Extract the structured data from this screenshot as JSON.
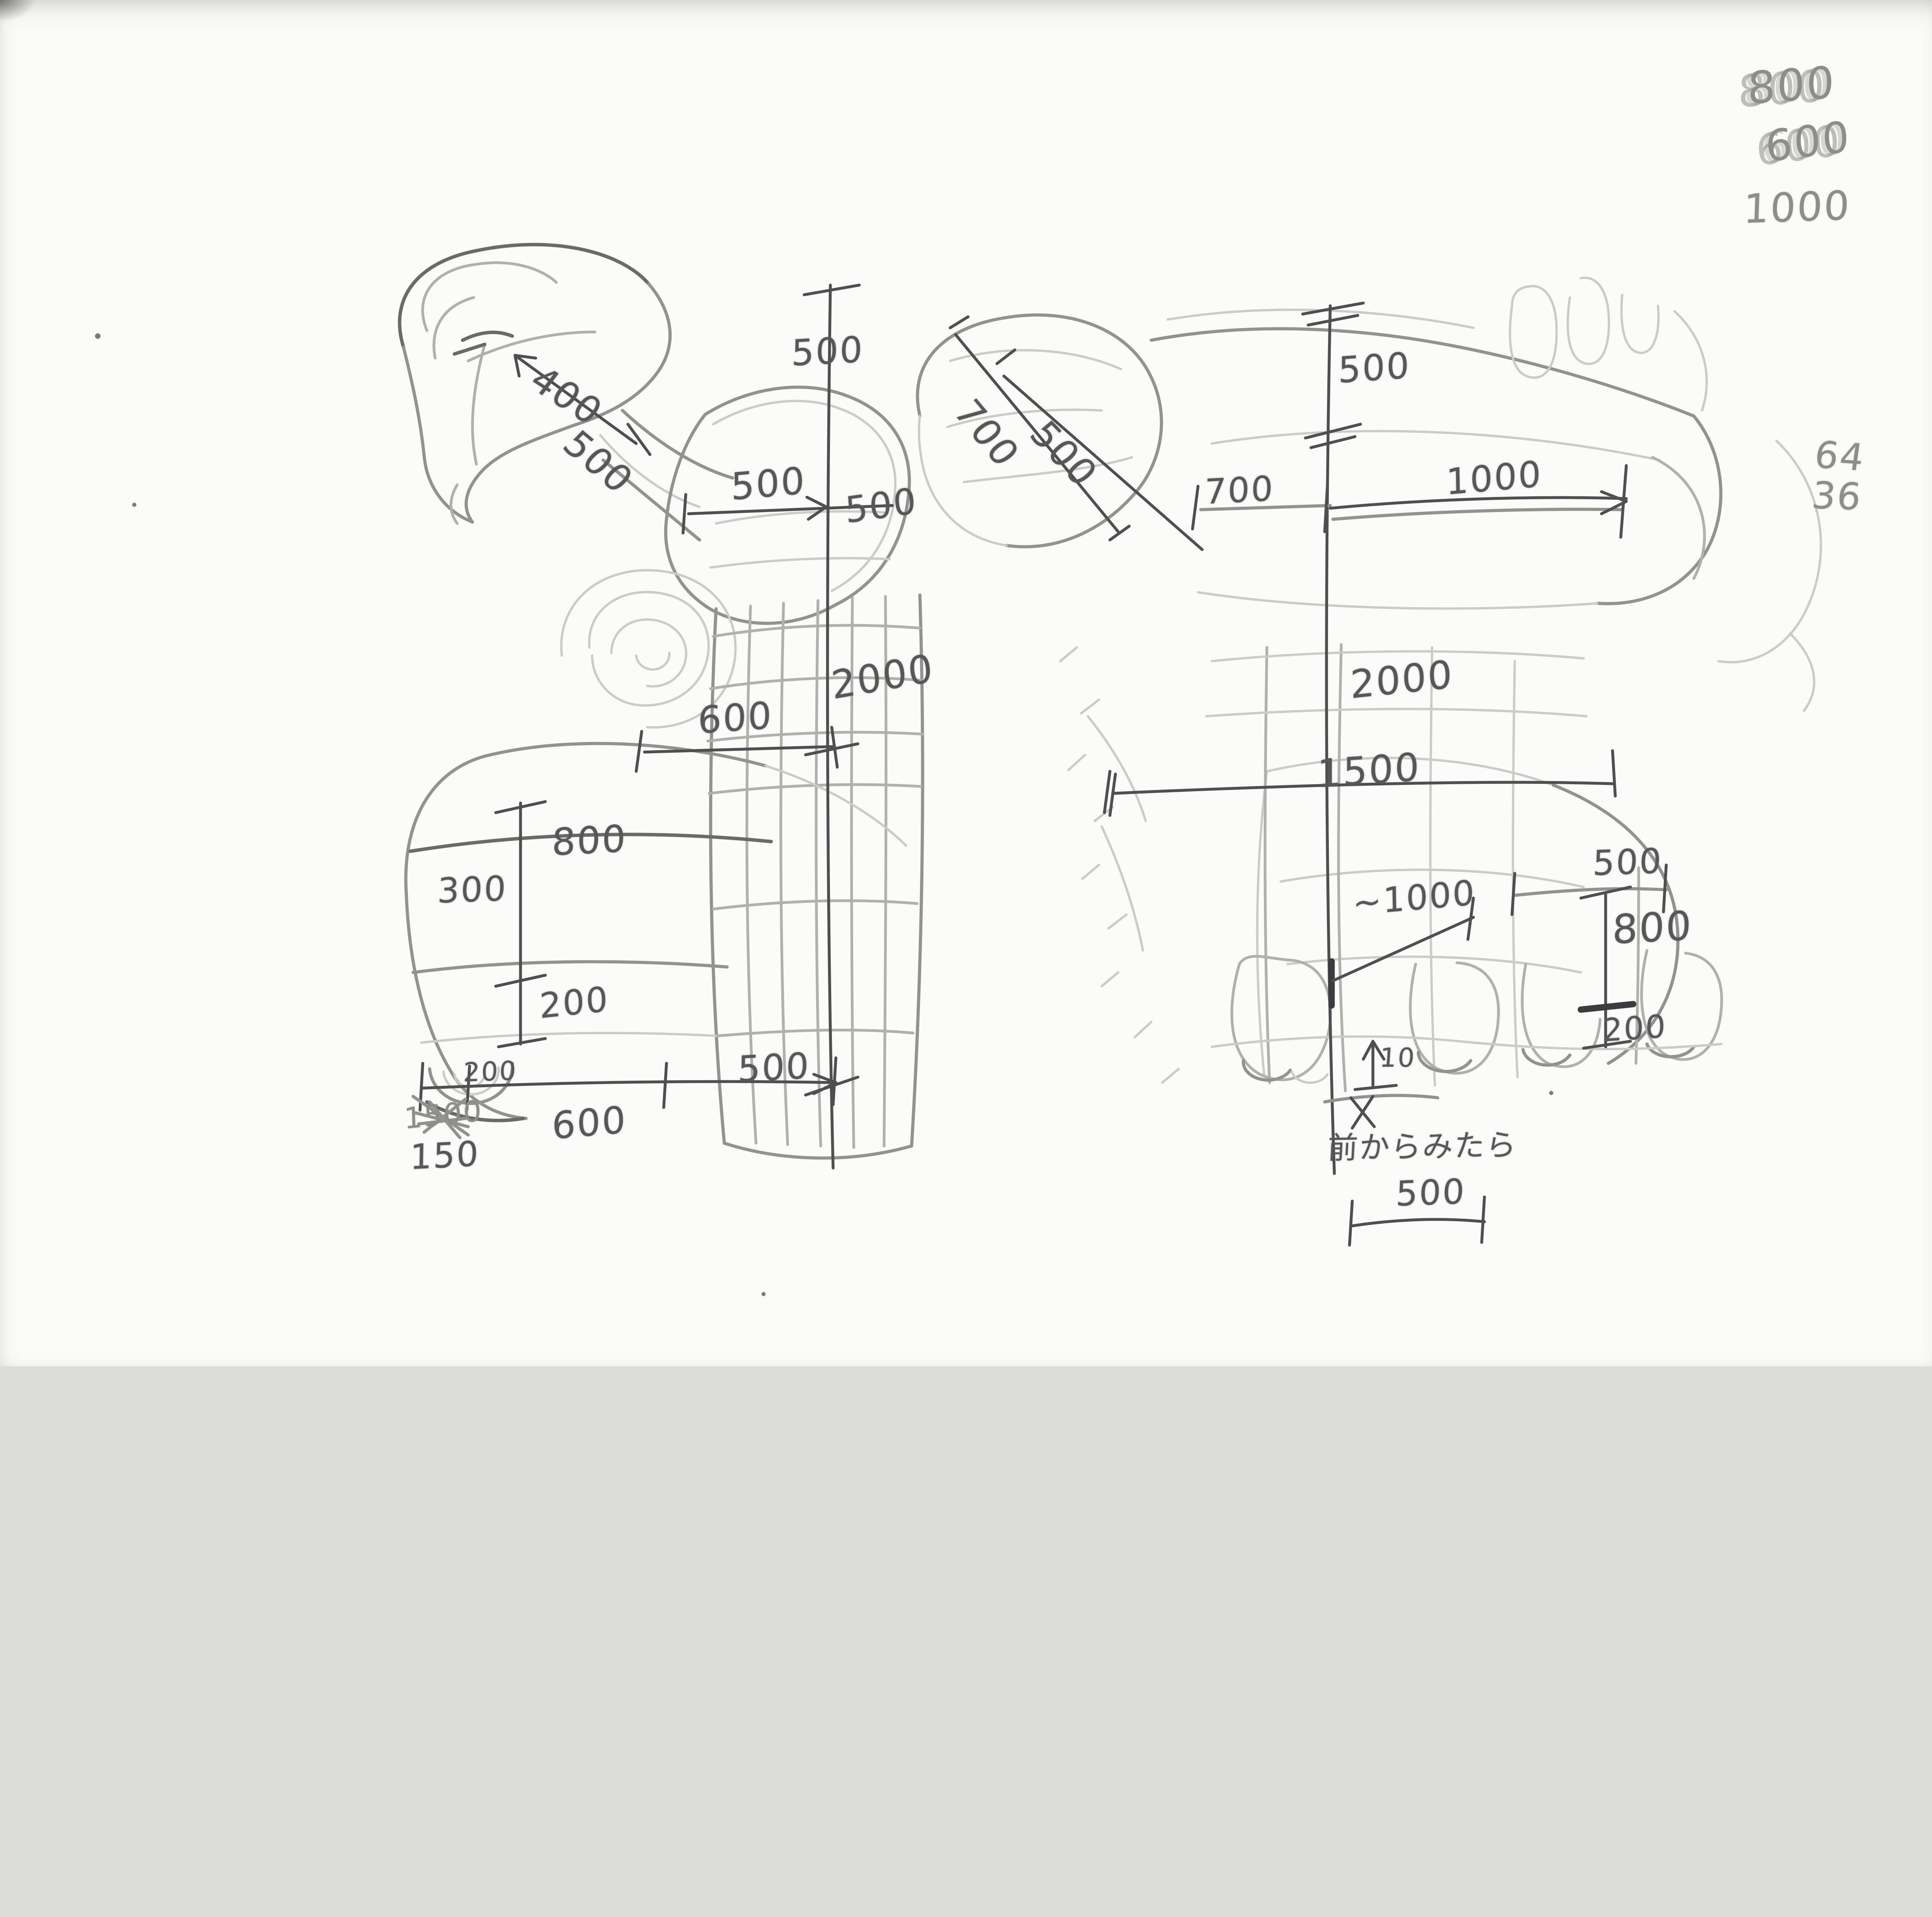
{
  "colors": {
    "paper": "#fbfbf9",
    "pencil_light": "#cbcbc8",
    "pencil": "#92928f",
    "pencil_dark": "#4f4f51"
  },
  "scratch_notes": {
    "top_right": {
      "line1": "800",
      "line2": "600",
      "line3": "1000"
    },
    "right_margin": {
      "line1": "64",
      "line2": "36"
    }
  },
  "side_view": {
    "label_500_top_segment": "500",
    "label_400_head_length": "400",
    "label_500_head_width": "500",
    "label_500_chest_width": "500",
    "label_500_height_right": "500",
    "label_2000_total_height": "2000",
    "label_600_hip_width": "600",
    "lower": {
      "label_800_thigh": "800",
      "label_300_band": "300",
      "label_200_shin": "200",
      "label_200_foot_roll": "200",
      "label_500_foot_length": "500",
      "label_600_base": "600",
      "label_crossed_out": "1500",
      "label_150_offset": "150"
    }
  },
  "front_view": {
    "label_700_head_diag": "700",
    "label_500_head_diag": "500",
    "label_500_top_segment": "500",
    "label_700_shoulder": "700",
    "label_1000_arm": "1000",
    "label_2000_total_height": "2000",
    "label_1500_body_width": "1500",
    "label_1000_belly_width": "~1000",
    "label_500_hip_band": "500",
    "label_800_leg_height": "800",
    "label_200_ankle": "200",
    "label_10_ground_gap": "10",
    "caption": "前からみたら",
    "label_500_foot_width": "500"
  }
}
